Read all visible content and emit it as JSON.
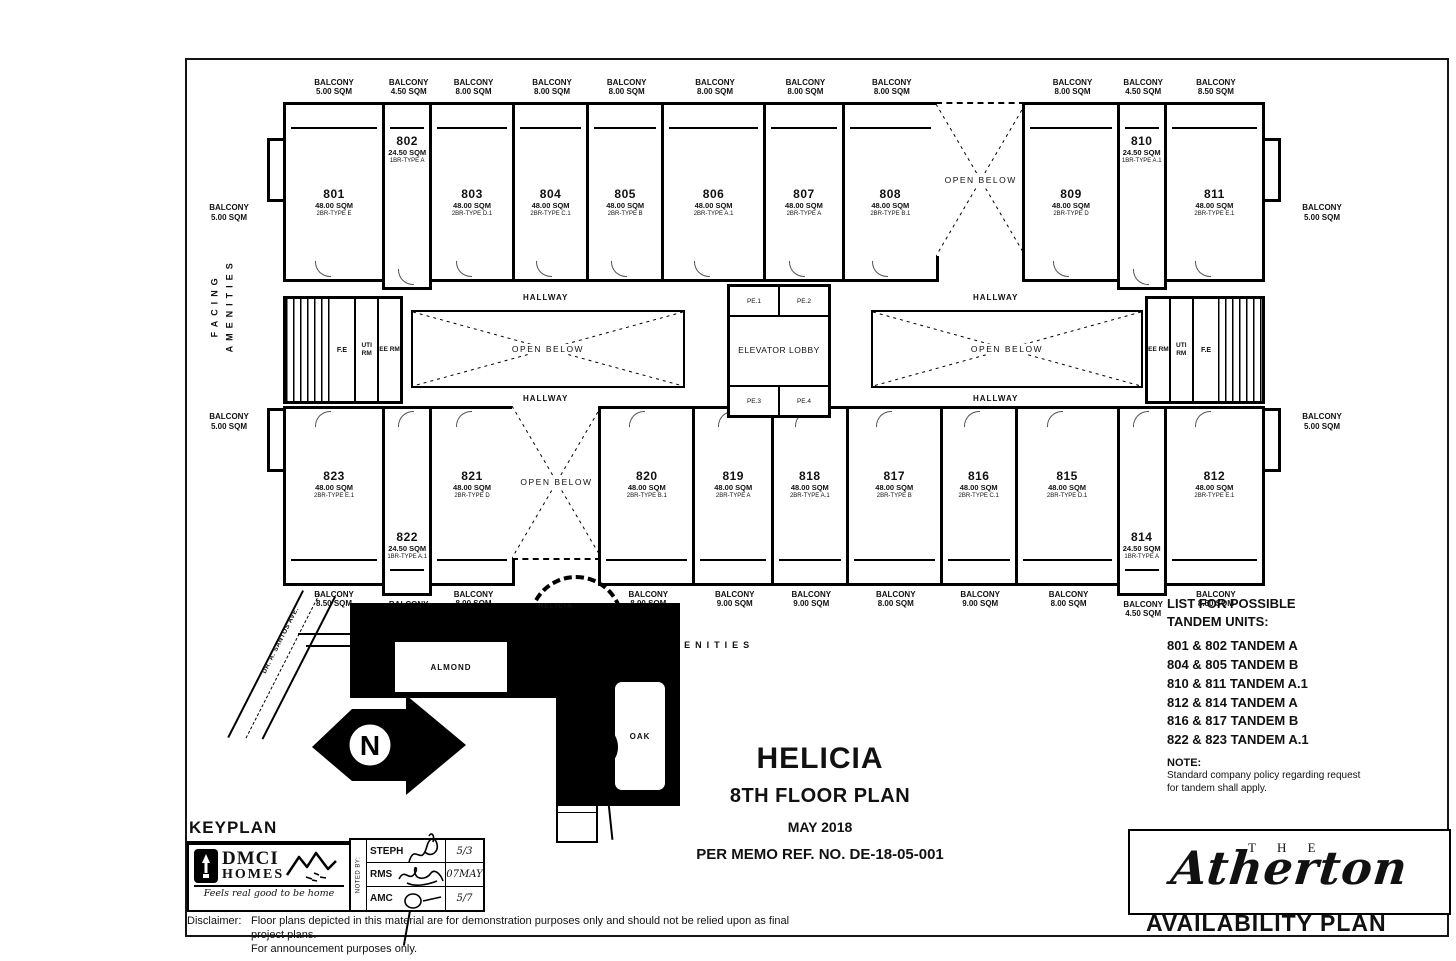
{
  "plan": {
    "balcony_word": "BALCONY",
    "hallway": "HALLWAY",
    "open_below": "OPEN BELOW",
    "elevator_lobby": "ELEVATOR LOBBY",
    "elevators": [
      "PE.1",
      "PE.2",
      "PE.3",
      "PE.4"
    ],
    "fire_exit": "F.E",
    "utility_room": "UTI RM",
    "electrical_room": "EE RM",
    "side_balcony_area": "5.00 SQM",
    "facing_amenities": "FACING AMENITIES",
    "top_units": [
      {
        "number": "801",
        "area": "48.00 SQM",
        "type": "2BR-TYPE E",
        "balcony": "5.00 SQM"
      },
      {
        "number": "802",
        "area": "24.50 SQM",
        "type": "1BR-TYPE A",
        "balcony": "4.50 SQM"
      },
      {
        "number": "803",
        "area": "48.00 SQM",
        "type": "2BR-TYPE D.1",
        "balcony": "8.00 SQM"
      },
      {
        "number": "804",
        "area": "48.00 SQM",
        "type": "2BR-TYPE C.1",
        "balcony": "8.00 SQM"
      },
      {
        "number": "805",
        "area": "48.00 SQM",
        "type": "2BR-TYPE B",
        "balcony": "8.00 SQM"
      },
      {
        "number": "806",
        "area": "48.00 SQM",
        "type": "2BR-TYPE A.1",
        "balcony": "8.00 SQM"
      },
      {
        "number": "807",
        "area": "48.00 SQM",
        "type": "2BR-TYPE A",
        "balcony": "8.00 SQM"
      },
      {
        "number": "808",
        "area": "48.00 SQM",
        "type": "2BR-TYPE B.1",
        "balcony": "8.00 SQM"
      },
      {
        "number": "809",
        "area": "48.00 SQM",
        "type": "2BR-TYPE D",
        "balcony": "8.00 SQM"
      },
      {
        "number": "810",
        "area": "24.50 SQM",
        "type": "1BR-TYPE A.1",
        "balcony": "4.50 SQM"
      },
      {
        "number": "811",
        "area": "48.00 SQM",
        "type": "2BR-TYPE E.1",
        "balcony": "8.50 SQM"
      }
    ],
    "bottom_units": [
      {
        "number": "823",
        "area": "48.00 SQM",
        "type": "2BR-TYPE E.1",
        "balcony": "8.50 SQM"
      },
      {
        "number": "822",
        "area": "24.50 SQM",
        "type": "1BR-TYPE A.1",
        "balcony": "4.50 SQM"
      },
      {
        "number": "821",
        "area": "48.00 SQM",
        "type": "2BR-TYPE D",
        "balcony": "8.00 SQM"
      },
      {
        "number": "820",
        "area": "48.00 SQM",
        "type": "2BR-TYPE B.1",
        "balcony": "8.00 SQM"
      },
      {
        "number": "819",
        "area": "48.00 SQM",
        "type": "2BR-TYPE A",
        "balcony": "9.00 SQM"
      },
      {
        "number": "818",
        "area": "48.00 SQM",
        "type": "2BR-TYPE A.1",
        "balcony": "9.00 SQM"
      },
      {
        "number": "817",
        "area": "48.00 SQM",
        "type": "2BR-TYPE B",
        "balcony": "8.00 SQM"
      },
      {
        "number": "816",
        "area": "48.00 SQM",
        "type": "2BR-TYPE C.1",
        "balcony": "9.00 SQM"
      },
      {
        "number": "815",
        "area": "48.00 SQM",
        "type": "2BR-TYPE D.1",
        "balcony": "8.00 SQM"
      },
      {
        "number": "814",
        "area": "24.50 SQM",
        "type": "1BR-TYPE A",
        "balcony": "4.50 SQM"
      },
      {
        "number": "812",
        "area": "48.00 SQM",
        "type": "2BR-TYPE E.1",
        "balcony": "8.50 SQM"
      }
    ]
  },
  "tandem": {
    "title_line1": "LIST FOR POSSIBLE",
    "title_line2": "TANDEM UNITS:",
    "items": [
      "801 & 802 TANDEM A",
      "804 & 805 TANDEM B",
      "810 & 811 TANDEM A.1",
      "812 & 814 TANDEM A",
      "816 & 817 TANDEM B",
      "822 & 823 TANDEM A.1"
    ]
  },
  "note": {
    "title": "NOTE:",
    "line1": "Standard company policy regarding request",
    "line2": "for tandem shall apply."
  },
  "titleblock": {
    "project": "HELICIA",
    "floor": "8TH FLOOR PLAN",
    "date": "MAY 2018",
    "memo": "PER MEMO REF. NO. DE-18-05-001"
  },
  "keyplan": {
    "label": "KEYPLAN",
    "site": {
      "helicia": "HELICIA",
      "almond": "ALMOND",
      "oak": "OAK",
      "street": "DR. A. SANTOS AVE.",
      "north": "N"
    },
    "logo": {
      "line1": "DMCI",
      "line2": "HOMES",
      "tagline": "Feels real good to be home"
    },
    "noted_by": "NOTED BY:",
    "approvals": [
      {
        "name": "STEPH",
        "date": "5/3"
      },
      {
        "name": "RMS",
        "date": "07MAY"
      },
      {
        "name": "AMC",
        "date": "5/7"
      }
    ]
  },
  "disclaimer": {
    "label": "Disclaimer:",
    "line1": "Floor plans depicted in this material are for demonstration purposes only and should not be relied upon as final project plans.",
    "line2": "For announcement purposes only."
  },
  "brand": {
    "the": "T H E",
    "name": "Atherton",
    "plan_type": "AVAILABILITY PLAN"
  }
}
